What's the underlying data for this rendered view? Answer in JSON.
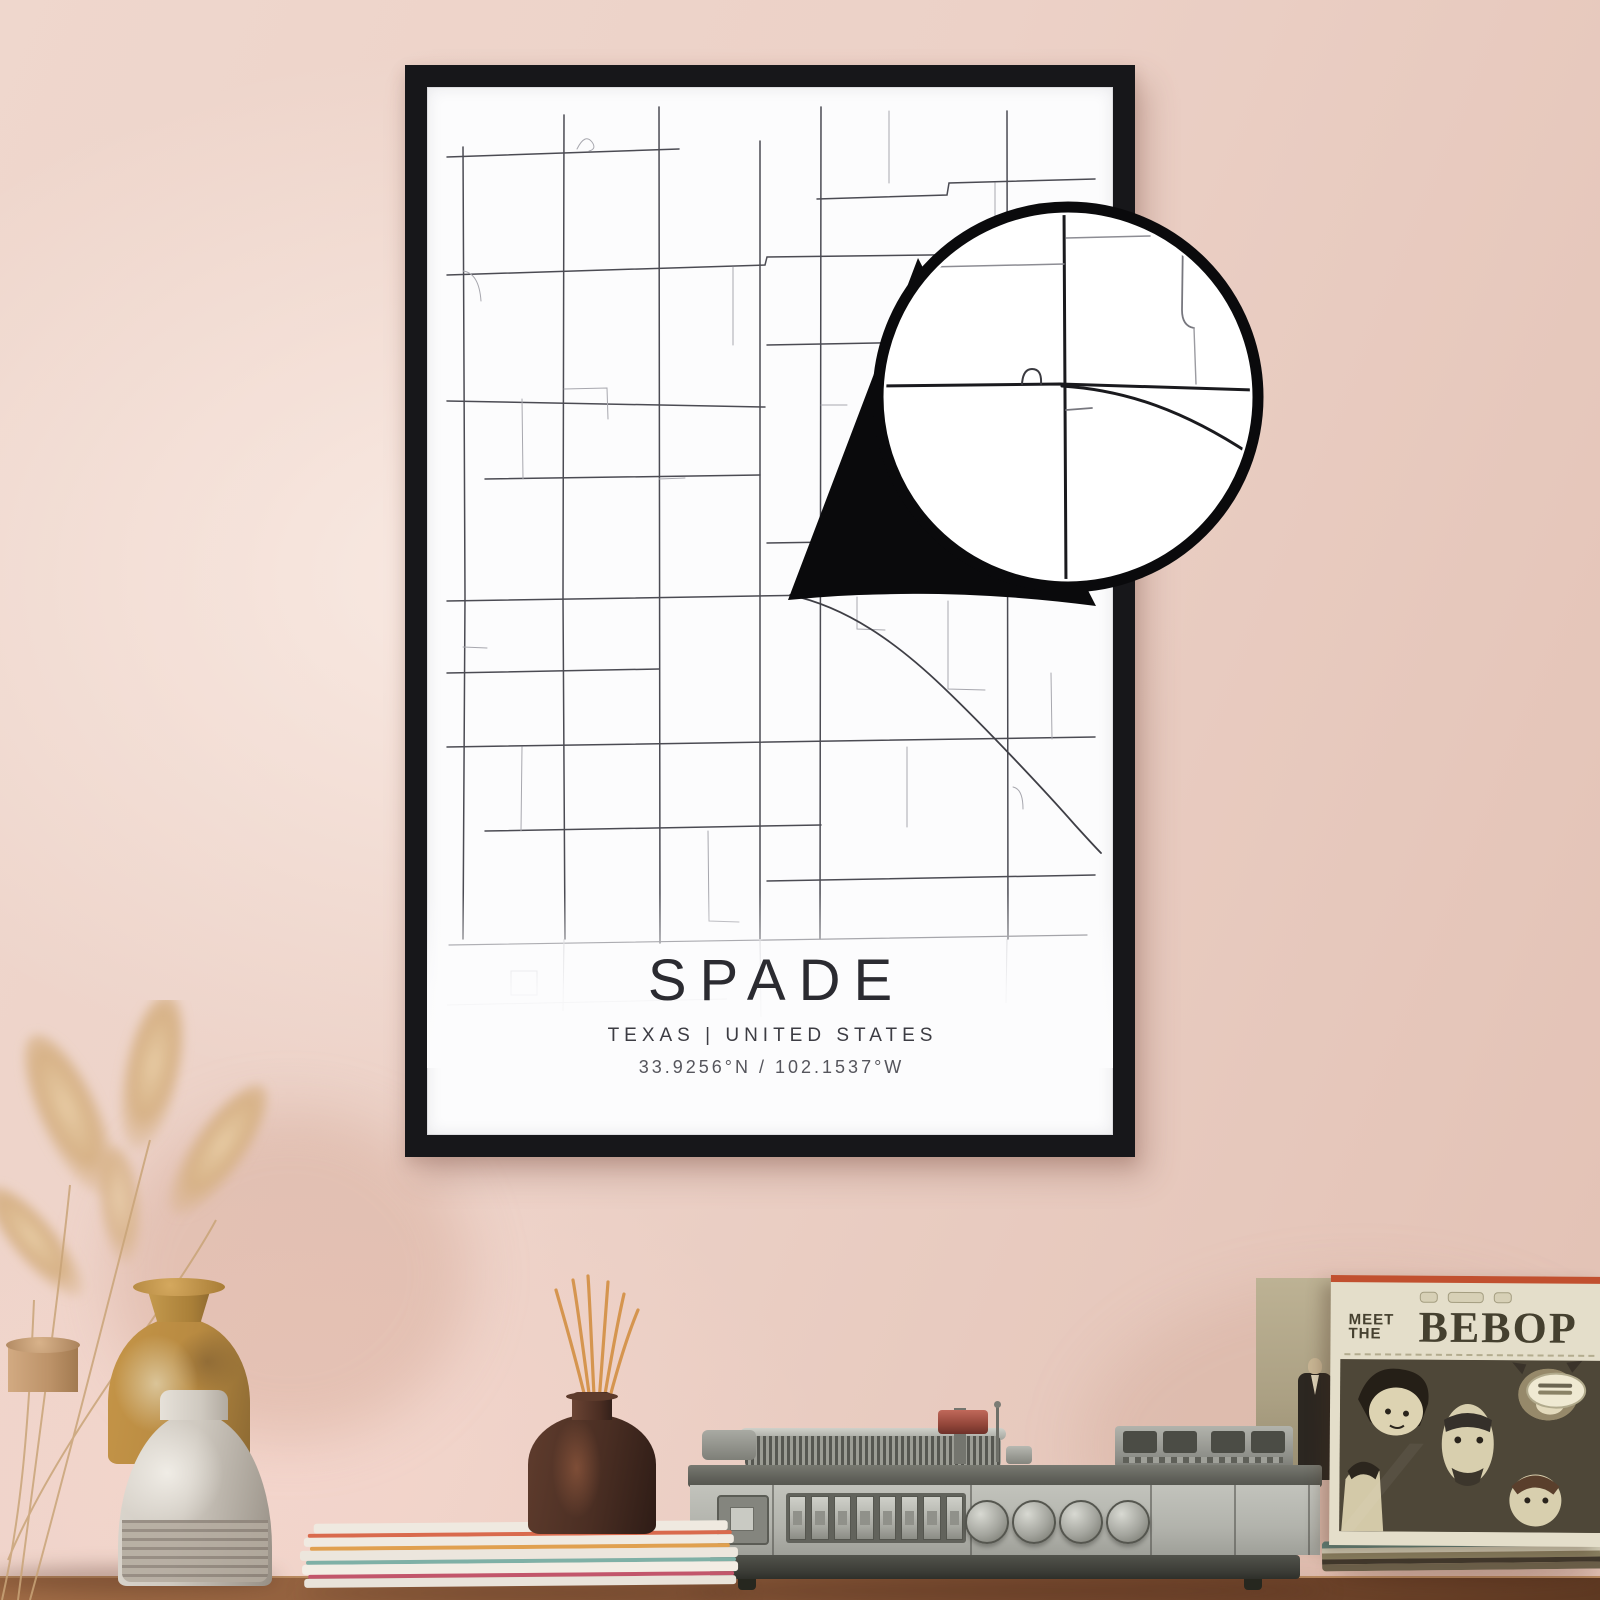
{
  "scene": {
    "wall_color": "#ecd2c8",
    "table_color": "#7c4e32"
  },
  "poster": {
    "title": "SPADE",
    "region_line": "TEXAS | UNITED STATES",
    "coordinates_line": "33.9256°N / 102.1537°W",
    "frame_color": "#17171a",
    "paper_color": "#fcfcfd",
    "street_color_major": "#4b4b53",
    "street_color_minor": "#a7a7ae",
    "highway_color": "#3f3f46"
  },
  "magnifier": {
    "ring_color": "#0a0a0c",
    "fill_color": "#ffffff"
  },
  "shelf": {
    "vases": [
      {
        "label": "tan-clay-vase",
        "color": "#c39b70"
      },
      {
        "label": "amber-glazed-vase",
        "color": "#b88a41"
      },
      {
        "label": "ribbed-stone-vase",
        "color": "#cfc9c0"
      }
    ],
    "diffuser": {
      "bottle_color": "#4a2e23",
      "reed_color": "#d2914f"
    },
    "turntable": {
      "body_color": "#b2b3ac",
      "trim_color": "#60615a"
    },
    "sleeve": {
      "title_top": "MEET",
      "title_mid": "THE",
      "title_main": "BEBOP",
      "cover_color": "#e4deca",
      "art_color": "#4e4738"
    }
  }
}
